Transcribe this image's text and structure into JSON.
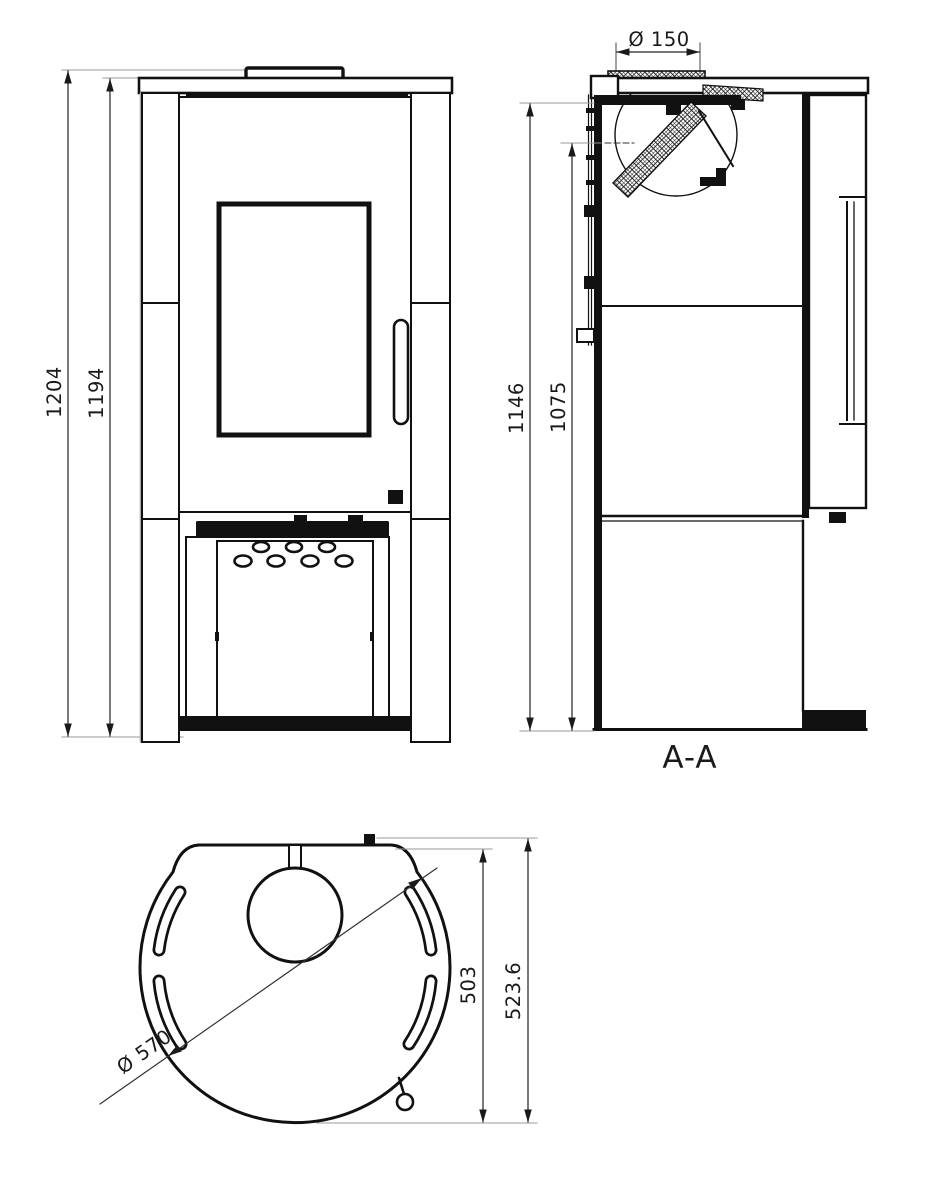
{
  "drawing": {
    "front_view": {
      "dim_overall_height": "1204",
      "dim_top_plate_height": "1194"
    },
    "section_view": {
      "flue_diameter_label": "Ø 150",
      "dim_height_to_flue_top": "1146",
      "dim_height_to_outlet_center": "1075",
      "section_label": "A-A"
    },
    "top_view": {
      "body_diameter_label": "Ø 570",
      "dim_depth_to_front_edge": "503",
      "dim_overall_depth": "523.6"
    },
    "colors": {
      "line": "#1a1a1a",
      "dimension_line": "#222222",
      "extension_line": "#999999",
      "background": "#ffffff"
    }
  }
}
